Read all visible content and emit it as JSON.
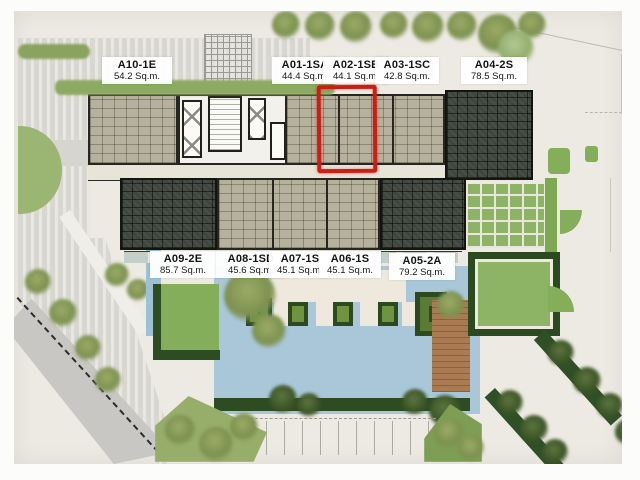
{
  "site_plan": {
    "description": "Condominium floor / site plan photo with unit labels and pool landscape",
    "highlighted_unit": "A02-1SB",
    "units": [
      {
        "name": "A10-1E",
        "area": "54.2 Sq.m.",
        "row": "top",
        "style": "light"
      },
      {
        "name": "A01-1SA",
        "area": "44.4 Sq.m.",
        "row": "top",
        "style": "light"
      },
      {
        "name": "A02-1SB",
        "area": "44.1 Sq.m.",
        "row": "top",
        "style": "light",
        "highlighted": true
      },
      {
        "name": "A03-1SC",
        "area": "42.8 Sq.m.",
        "row": "top",
        "style": "light"
      },
      {
        "name": "A04-2S",
        "area": "78.5 Sq.m.",
        "row": "top",
        "style": "dark"
      },
      {
        "name": "A09-2E",
        "area": "85.7 Sq.m.",
        "row": "bottom",
        "style": "dark"
      },
      {
        "name": "A08-1SD",
        "area": "45.6 Sq.m.",
        "row": "bottom",
        "style": "light"
      },
      {
        "name": "A07-1S",
        "area": "45.1 Sq.m.",
        "row": "bottom",
        "style": "light"
      },
      {
        "name": "A06-1S",
        "area": "45.1 Sq.m.",
        "row": "bottom",
        "style": "light"
      },
      {
        "name": "A05-2A",
        "area": "79.2 Sq.m.",
        "row": "bottom",
        "style": "dark"
      }
    ],
    "colors": {
      "highlight_red": "#cb1d13",
      "pool_blue": "#a9c7d9",
      "lawn_green": "#84ae5a",
      "hedge_green": "#2e4c22",
      "unit_light": "#b6b19d",
      "unit_dark": "#3f463e",
      "wood_deck": "#aa7b52",
      "paving_gray": "#d8d7d1"
    }
  }
}
